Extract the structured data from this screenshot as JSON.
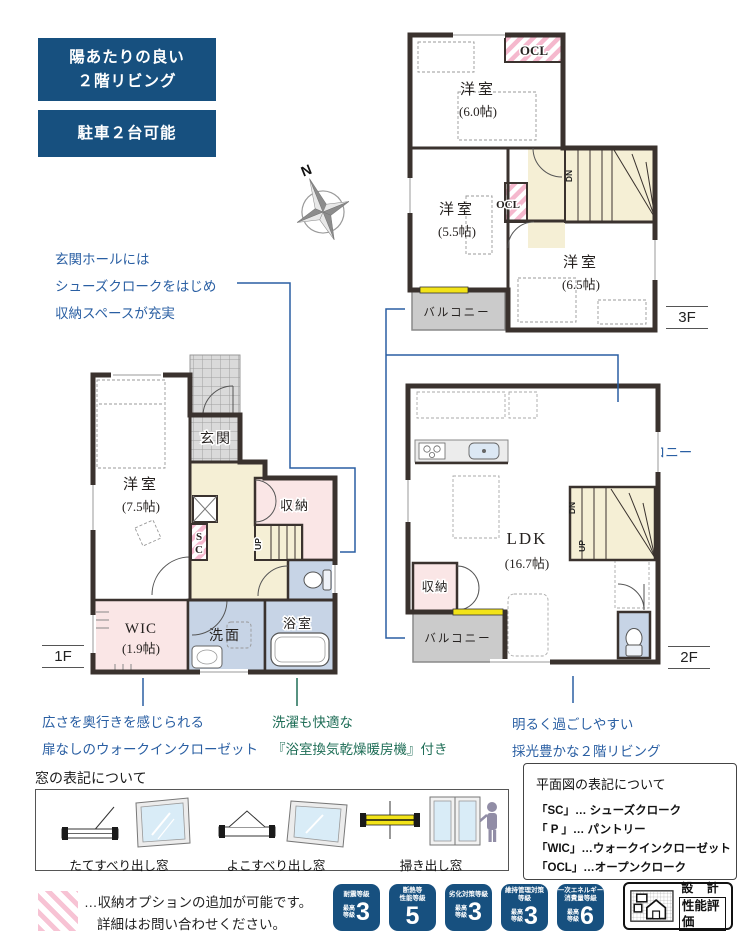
{
  "colors": {
    "navy": "#17507f",
    "blue_text": "#2a5fa3",
    "green_text": "#1f6e57",
    "wall": "#3a322e",
    "pink_room": "#fae6e6",
    "pink_stripe": "#f5b8cd",
    "cream_room": "#f5efd5",
    "blue_room": "#c7d4e6",
    "gray_balcony": "#cbcbcb",
    "yellow_window": "#f2e318"
  },
  "feature_badges": [
    {
      "line1": "陽あたりの良い",
      "line2": "２階リビング"
    },
    {
      "line1": "駐車２台可能",
      "line2": ""
    }
  ],
  "compass": {
    "label": "N"
  },
  "callouts": {
    "entry": {
      "line1": "玄関ホールには",
      "line2": "シューズクロークをはじめ",
      "line3": "収納スペースが充実"
    },
    "balcony": {
      "line1": "明るい",
      "line2": "南西バルコニー"
    },
    "wic": {
      "line1": "広さを奥行きを感じられる",
      "line2": "扉なしのウォークインクローゼット"
    },
    "bath": {
      "line1": "洗濯も快適な",
      "line2": "『浴室換気乾燥暖房機』付き"
    },
    "living": {
      "line1": "明るく過ごしやすい",
      "line2": "採光豊かな２階リビング"
    }
  },
  "floors": {
    "f1": {
      "label": "1F",
      "genkan": "玄関",
      "bedroom": "洋室",
      "bedroom_size": "(7.5帖)",
      "storage": "収納",
      "sc_l1": "S",
      "sc_l2": "C",
      "wic": "WIC",
      "wic_size": "(1.9帖)",
      "sanitary": "洗面",
      "bath": "浴室",
      "up": "UP"
    },
    "f2": {
      "label": "2F",
      "ldk": "LDK",
      "ldk_size": "(16.7帖)",
      "storage": "収納",
      "balcony": "バルコニー",
      "up": "UP",
      "dn": "DN"
    },
    "f3": {
      "label": "3F",
      "ocl_top": "OCL",
      "ocl_mid": "OCL",
      "bedroom1": "洋室",
      "bedroom1_size": "(6.0帖)",
      "bedroom2": "洋室",
      "bedroom2_size": "(5.5帖)",
      "bedroom3": "洋室",
      "bedroom3_size": "(6.5帖)",
      "balcony": "バルコニー",
      "dn": "DN"
    }
  },
  "window_legend": {
    "title": "窓の表記について",
    "items": [
      {
        "label": "たてすべり出し窓"
      },
      {
        "label": "よこすべり出し窓"
      },
      {
        "label": "掃き出し窓"
      }
    ]
  },
  "plan_legend": {
    "title": "平面図の表記について",
    "items": [
      {
        "text": "「SC」… シューズクローク"
      },
      {
        "text": "「 P 」… パントリー"
      },
      {
        "text": "「WIC」…ウォークインクローゼット"
      },
      {
        "text": "「OCL」…オープンクローク"
      }
    ]
  },
  "option_note": {
    "line1": "…収納オプションの追加が可能です。",
    "line2": "詳細はお問い合わせください。"
  },
  "performance_badges": [
    {
      "t1": "耐震等級",
      "t2": "",
      "p1": "最高",
      "p2": "等級",
      "value": "3"
    },
    {
      "t1": "断熱等",
      "t2": "性能等級",
      "p1": "",
      "p2": "",
      "value": "5"
    },
    {
      "t1": "劣化対策等級",
      "t2": "",
      "p1": "最高",
      "p2": "等級",
      "value": "3"
    },
    {
      "t1": "維持管理対策",
      "t2": "等級",
      "p1": "最高",
      "p2": "等級",
      "value": "3"
    },
    {
      "t1": "一次エネルギー",
      "t2": "消費量等級",
      "p1": "最高",
      "p2": "等級",
      "value": "6"
    }
  ],
  "cert_mark": {
    "line1": "設 計",
    "line2": "性能評価"
  }
}
